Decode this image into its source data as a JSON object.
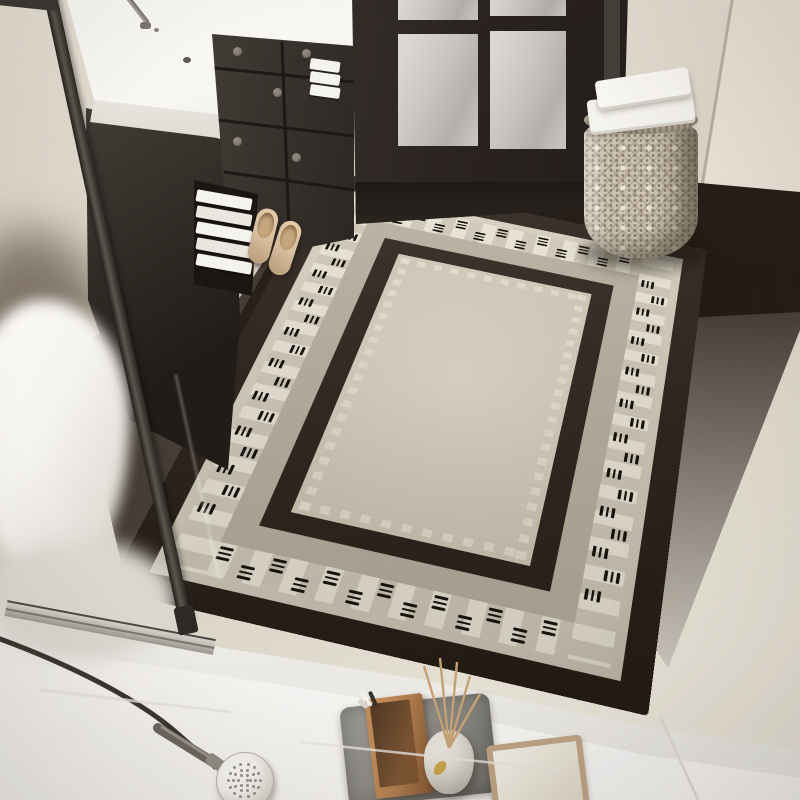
{
  "scene": {
    "title": "Top-down bathroom entryway photo: beige and black geometric bordered area rug in front of a dark glass-paned door, with a dark vanity, woven basket with towels, glass shower partition, toilet, shower head on marble floor, and bathroom accessories on trays",
    "objects": [
      "area-rug",
      "vanity-cabinet",
      "vanity-countertop",
      "faucet",
      "folded-towels-shelf",
      "glass-paned-door",
      "woven-basket",
      "folded-towels-basket",
      "slippers",
      "glass-shower-partition",
      "toilet",
      "shower-head-and-hose",
      "gray-tray",
      "wooden-box",
      "reed-diffuser-vase",
      "beige-tray",
      "marble-floor",
      "tile-strip"
    ]
  },
  "palette": {
    "wall": "#e7e0d5",
    "wallShade": "#cdc4b7",
    "wallRight": "#ede6da",
    "floorBeige": "#d6cfc2",
    "floorBeigeDark": "#c6bfb1",
    "marble": "#f2f0ed",
    "tileStrip": "#fafaf7",
    "darkFloor": "#241c16",
    "door": "#2a2320",
    "doorEdge": "#453f39",
    "glass": "#c8c5c0",
    "glassLight": "#dbd8d3",
    "counter": "#f8f6f2",
    "counterEdge": "#e8e5df",
    "cabinet": "#39332e",
    "knob": "#837b72",
    "shelfDark": "#1b1612",
    "towel": "#f5f3ee",
    "towelShadow": "#d7d2ca",
    "slipper": "#d8bf9f",
    "slipperDark": "#b59a79",
    "basket": "#cdc3b2",
    "basketDot": "#887d6a",
    "basketLight": "#ece4d3",
    "toilet": "#f6f4f0",
    "partition": "#3c3733",
    "partitionLight": "#5c564f",
    "rail": "#c0bcb5",
    "railDark": "#4e4943",
    "hose": "#3a342e",
    "showerHead": "#f1efea",
    "headDot": "#948f88",
    "trayGray": "#8b8983",
    "trayGrayLight": "#9c9a94",
    "trayGrayDark": "#6e6c67",
    "wood": "#af7b4d",
    "woodDark": "#4e3723",
    "vase": "#dedbd3",
    "vaseShade": "#a5a29a",
    "reed": "#c4a273",
    "gold": "#c9a24a",
    "trayBeige": "#bda385",
    "trayBeigeInner": "#f2eee4",
    "rugBlack": "#261d15",
    "rugBandOuter": "#d8d1c1",
    "rugBandInner": "#b6af9f",
    "rugCheckA": "#eae4d5",
    "rugCheckB": "#cfc8b8",
    "rugInnerBlack": "#2a2018",
    "rugField": "#d9d2c0",
    "rugFieldDot": "#e8e2d1",
    "rugDash": "#17110b"
  },
  "rug": {
    "description": "Rectangular rug: thick black outer border, greige band with checkered strip and triple-dash groups, black inner border, cream field with small square dot row",
    "dash_bands": [
      {
        "side": "top",
        "cross": 54,
        "start": 80,
        "step": 24,
        "count": 13
      },
      {
        "side": "bottom",
        "cross": 566,
        "start": 80,
        "step": 24,
        "count": 13
      },
      {
        "side": "left",
        "cross": 54,
        "start": 84,
        "step": 24,
        "count": 19
      },
      {
        "side": "right",
        "cross": 406,
        "start": 84,
        "step": 24,
        "count": 19
      }
    ],
    "dash": {
      "length": 12,
      "thickness": 2.6,
      "lane_gap": 5.6,
      "stagger": 7,
      "per_group": 3
    }
  },
  "vanity": {
    "shelf_towel_count": 5,
    "counter_towel_count": 3,
    "drawer_knob_count": 5
  },
  "basket": {
    "towel_count": 2
  },
  "diffuser": {
    "reed_count": 5
  },
  "shower_head": {
    "dot_rings": [
      [
        2.5,
        1
      ],
      [
        6,
        6
      ],
      [
        11,
        10
      ],
      [
        16,
        14
      ]
    ]
  }
}
